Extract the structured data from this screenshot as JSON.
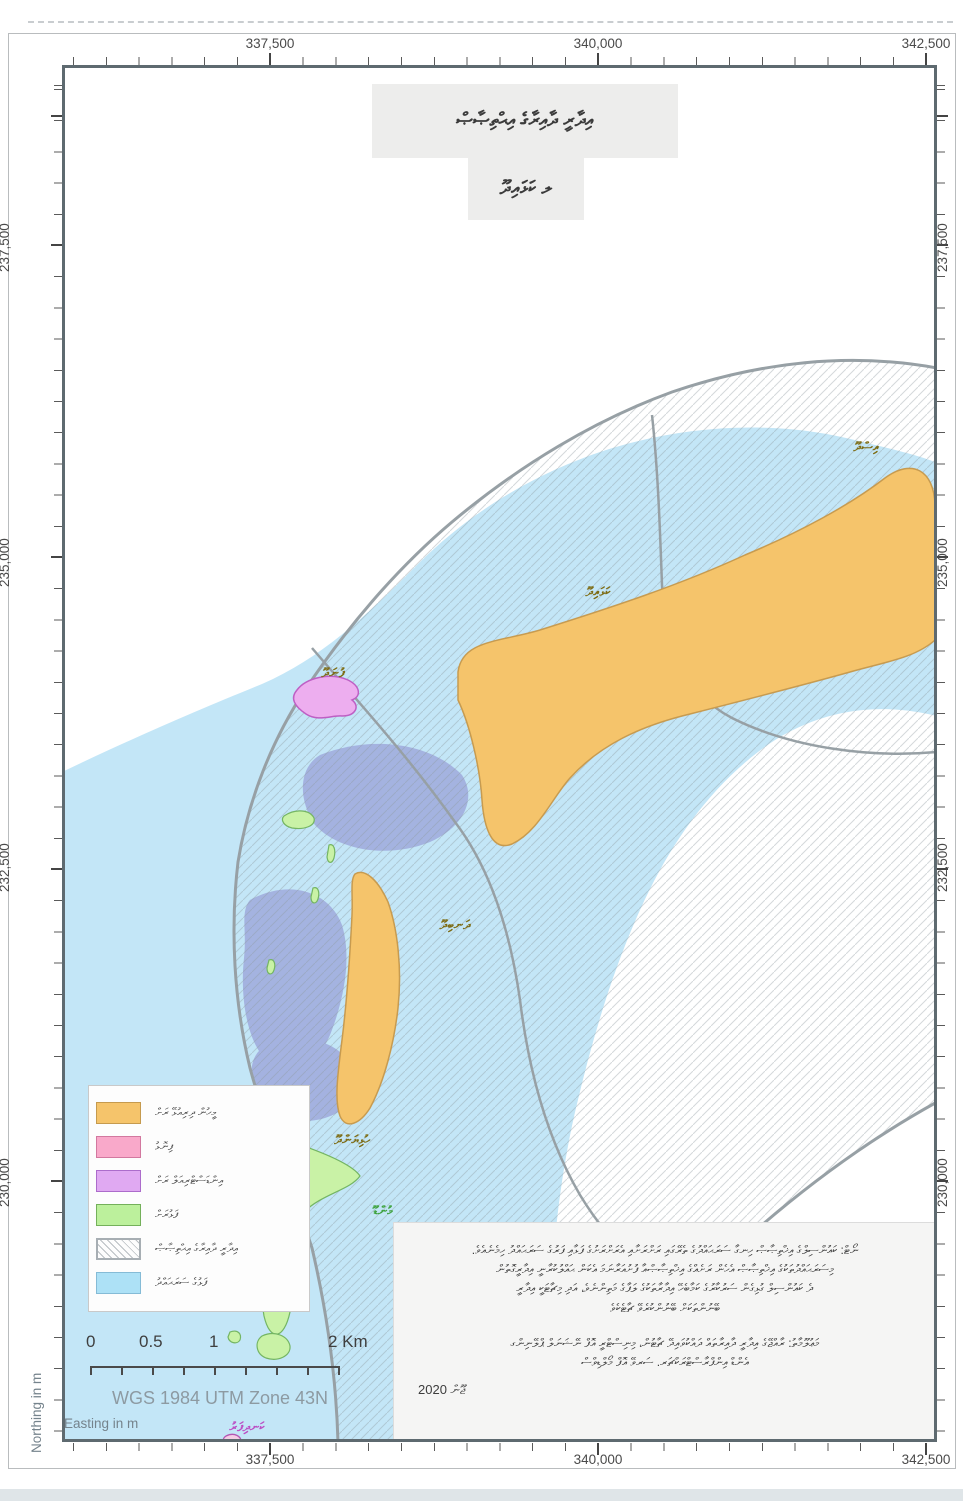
{
  "title": {
    "line1": "އިދާރީ ދާއިރާގެ އިޙްތިޞާޞް",
    "line2": "ލ ކަޅައިދޫ"
  },
  "axes": {
    "top": [
      "337,500",
      "340,000",
      "342,500"
    ],
    "bottom": [
      "337,500",
      "340,000",
      "342,500"
    ],
    "left": [
      "237,500",
      "235,000",
      "232,500",
      "230,000"
    ],
    "right": [
      "237,500",
      "235,000",
      "232,500",
      "230,000"
    ],
    "x_axis_label": "Easting in m",
    "y_axis_label": "Northing in m"
  },
  "map": {
    "island_labels": [
      {
        "id": "isdhoo",
        "text": "އިސްދޫ",
        "category": "inhabited-island"
      },
      {
        "id": "kalhaidhoo",
        "text": "ކަޅައިދޫ",
        "category": "inhabited-island"
      },
      {
        "id": "dhanbidhoo",
        "text": "ދަނބިދޫ",
        "category": "inhabited-island"
      },
      {
        "id": "funadhoo",
        "text": "ފުނަދޫ",
        "category": "industrial-island"
      },
      {
        "id": "hulhiyandhoo",
        "text": "ހުޅިޔަންދޫ",
        "category": "inhabited-island"
      },
      {
        "id": "mundoo",
        "text": "މުންޑޫ",
        "category": "uninhabited-island"
      },
      {
        "id": "kandifaru",
        "text": "ކަނދިފަރު",
        "category": "sandbank"
      }
    ],
    "colors": {
      "lagoon_blue": "#c3e6f7",
      "deep_patch_periwinkle": "#9fa9dc",
      "inhabited_island_orange": "#f5c46b",
      "sandbank_pink": "#f9a9ca",
      "industrial_island_violet": "#e0a9f2",
      "uninhabited_island_green": "#bcf09c",
      "jurisdiction_boundary_gray": "#97a0a5",
      "label_olive": "#7d6b13",
      "label_green": "#3fa33f",
      "label_magenta": "#bb4fc4"
    }
  },
  "legend": {
    "items": [
      {
        "swatch": "orange",
        "label": "މީހުން ދިރިއުޅޭ ރަށް"
      },
      {
        "swatch": "pink",
        "label": "ފިނޮޅު"
      },
      {
        "swatch": "violet",
        "label": "އިންޑަސްޓްރިއަލް ރަށް"
      },
      {
        "swatch": "green",
        "label": "ފަޅުރަށް"
      },
      {
        "swatch": "hatch",
        "label": "އިދާރީ ދާއިރާގެ އިޙްތިޞާޞް"
      },
      {
        "swatch": "blue",
        "label": "ފަޅުގެ ސަރަޙައްދު"
      }
    ]
  },
  "scalebar": {
    "labels": [
      "0",
      "0.5",
      "1",
      "2 Km"
    ],
    "crs": "WGS 1984 UTM Zone 43N"
  },
  "notes": {
    "p1_line1": "ނޯޓް: ކައުންސިލްގެ އިޚްތިޞާޞް ހިނގާ ސަރަޙައްދުގެ ތެރޭގައި ރަށްރަށާއި އެރަށްރަށުގެ ފަޅާއި ފަރުގެ ސަރަޙައްދު ހިމެނެއެވެ.",
    "p1_line2": "މިސަރަޙައްދުތަކުގެ އިޚްތިޞާޞް އެހެން ރަށެއްގެ އިޚްތިޞާޞްއާ ފުށުއަރާނަމަ އެކަން ޙައްލުކުރާނީ އިދާރީގޮތުން",
    "p1_line3": "ދެ ކައުންސިލް ގުޅިގެން ސަރުކާރުގެ ކަމާބެހޭ އިދާރާތަކުގެ ލަފާގެ މަތިންނެވެ، އަދި މިޗާޓަކީ އިދާރީ",
    "p1_line4": "ބޭނުންތަކަށް ބޭނުންކުރެވޭ ޗާޓެކެވެ",
    "p2_line1": "މަޢުލޫމާތު: ރާއްޖޭގެ އިދާރީ ދާއިރާތައް ދައްކުވައިދޭ ޗާޓުން، މިނިސްޓްރީ އޮފް ނޭޝަނަލް ޕްލޭނިންގ",
    "p2_line2": "އެންޑް އިންފްރާސްޓްރަކްޗަރ. ސަރވޭ އޮފް މޯލްޑިވްސް",
    "date": "ޖޫން 2020"
  }
}
